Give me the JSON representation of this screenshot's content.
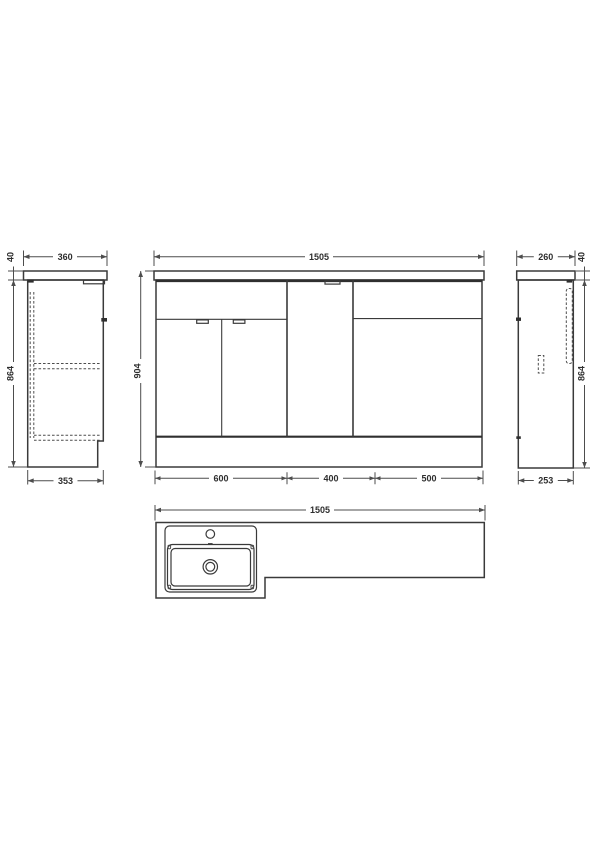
{
  "drawing": {
    "type": "technical-dimension-drawing",
    "line_color": "#3a3a3a",
    "dim_color": "#4d4d4d",
    "background": "#ffffff",
    "views": {
      "left_side": {
        "width_top": "360",
        "counter_thickness": "40",
        "body_height": "864",
        "depth_bottom": "353"
      },
      "front": {
        "overall_width": "1505",
        "overall_height": "904",
        "section_left": "600",
        "section_middle": "400",
        "section_right": "500"
      },
      "right_side": {
        "width_top": "260",
        "counter_thickness": "40",
        "body_height": "864",
        "depth_bottom": "253"
      },
      "plan": {
        "overall_width": "1505"
      }
    }
  }
}
